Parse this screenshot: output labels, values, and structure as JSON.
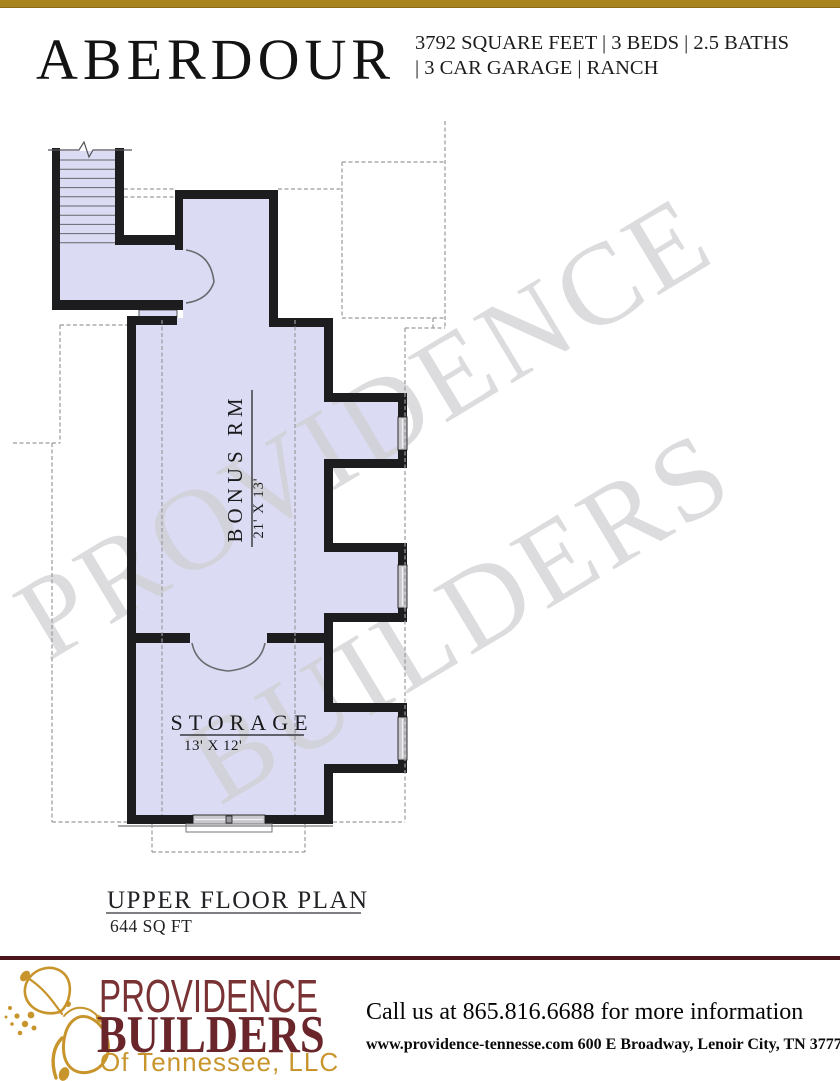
{
  "header": {
    "title": "ABERDOUR",
    "specs_line1": "3792 SQUARE FEET | 3 BEDS | 2.5 BATHS",
    "specs_line2": "| 3 CAR GARAGE | RANCH"
  },
  "plan": {
    "watermark": {
      "line1": "PROVIDENCE",
      "line2": "BUILDERS"
    },
    "rooms": [
      {
        "name": "BONUS RM",
        "dims": "21' X 13'"
      },
      {
        "name": "STORAGE",
        "dims": "13' X 12'"
      }
    ],
    "caption": {
      "title": "UPPER  FLOOR  PLAN",
      "area": "644  SQ FT"
    }
  },
  "footer": {
    "logo": {
      "line1": "PROVIDENCE",
      "line2": "BUILDERS",
      "line3": "Of Tennessee, LLC"
    },
    "phone": "Call us at 865.816.6688 for more information",
    "address": "www.providence-tennesse.com 600 E Broadway, Lenoir City, TN 37771"
  },
  "colors": {
    "top_bar_gold": "#a8841f",
    "footer_rule_maroon": "#4a151b",
    "logo_maroon": "#69252a",
    "logo_gold": "#c8952d",
    "plan_fill": "#dbdbf3",
    "wall": "#1d1d20",
    "watermark_gray": "#cfcfd2"
  }
}
